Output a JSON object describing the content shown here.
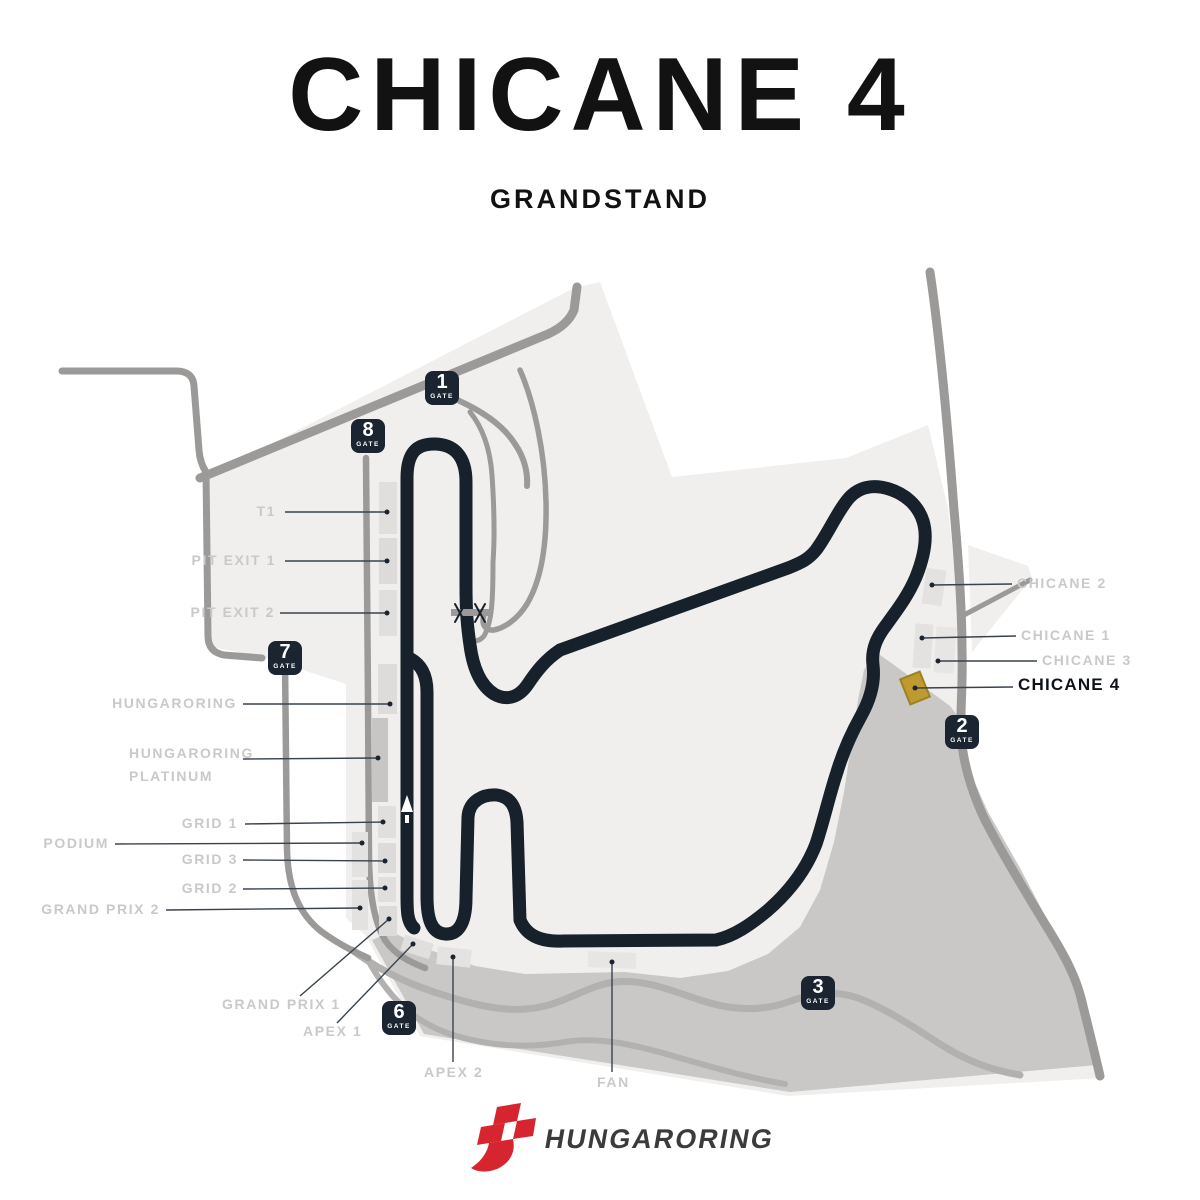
{
  "title": "CHICANE 4",
  "subtitle": "GRANDSTAND",
  "brand": {
    "name": "HUNGARORING"
  },
  "map": {
    "gate_caption": "GATE",
    "gates": [
      {
        "number": "1"
      },
      {
        "number": "8"
      },
      {
        "number": "7"
      },
      {
        "number": "6"
      },
      {
        "number": "2"
      },
      {
        "number": "3"
      }
    ],
    "grandstands": [
      {
        "label": "T1"
      },
      {
        "label": "PIT EXIT 1"
      },
      {
        "label": "PIT EXIT 2"
      },
      {
        "label": "HUNGARORING"
      },
      {
        "label": "HUNGARORING\nPLATINUM"
      },
      {
        "label": "GRID 1"
      },
      {
        "label": "PODIUM"
      },
      {
        "label": "GRID 3"
      },
      {
        "label": "GRID 2"
      },
      {
        "label": "GRAND PRIX 2"
      },
      {
        "label": "GRAND PRIX 1"
      },
      {
        "label": "APEX 1"
      },
      {
        "label": "APEX 2"
      },
      {
        "label": "FAN"
      },
      {
        "label": "CHICANE 2"
      },
      {
        "label": "CHICANE 1"
      },
      {
        "label": "CHICANE 3"
      },
      {
        "label": "CHICANE 4"
      }
    ],
    "highlighted_grandstand": "CHICANE 4",
    "colors": {
      "track": "#16212c",
      "venue_light": "#f0efed",
      "hillside_dark": "#c9c8c6",
      "road": "#9b9a99",
      "hillside_road": "#b2b1af",
      "block": "#e0dfdd",
      "block_dark": "#c8c6c4",
      "highlight_gold": "#bf9b2f",
      "gate_badge": "#1a2531",
      "label_gray": "#c9c9c9",
      "logo_red": "#d6252e"
    }
  }
}
